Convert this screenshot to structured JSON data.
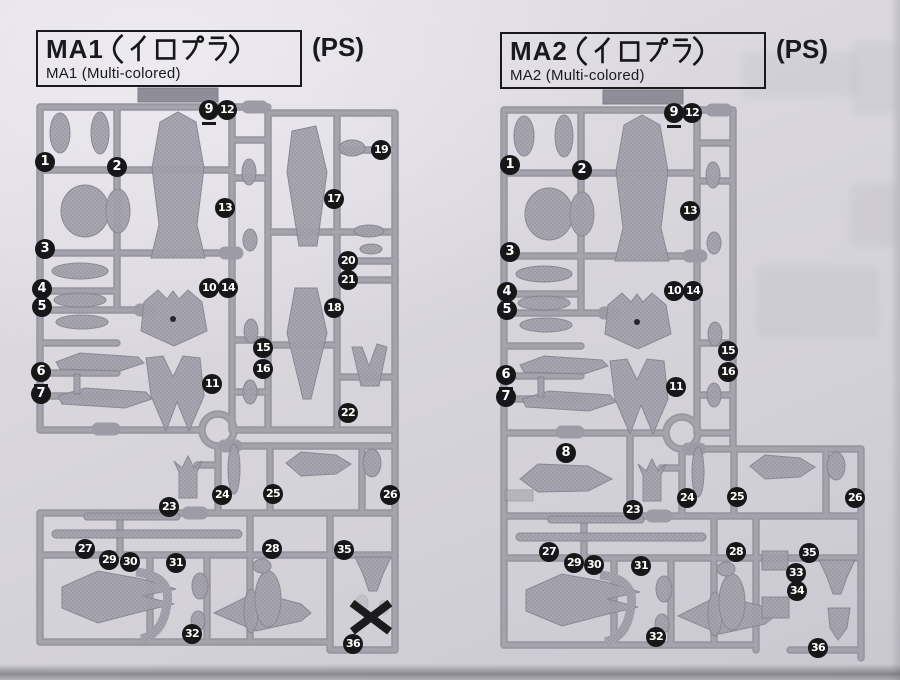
{
  "colors": {
    "paper": "#d9d7dd",
    "paper_light": "#e6e4ea",
    "runner": "#a7a5ae",
    "runner_dark": "#908e98",
    "runner_light": "#bbb9c1",
    "part": "#a3a1ab",
    "ink": "#1a1a1c",
    "badge_bg": "#17171a",
    "badge_fg": "#ffffff",
    "tab": "#97959f"
  },
  "panels": [
    {
      "id": "MA1",
      "title_prefix": "MA1",
      "title_kana_full": "（イロプラ）",
      "title_jp_full": "MA1（イロプラ）",
      "ps_label": "(PS)",
      "subtitle": "MA1 (Multi-colored)",
      "badges": [
        {
          "n": 1,
          "x": 45,
          "y": 162
        },
        {
          "n": 2,
          "x": 117,
          "y": 167
        },
        {
          "n": 3,
          "x": 45,
          "y": 249
        },
        {
          "n": 4,
          "x": 42,
          "y": 289
        },
        {
          "n": 5,
          "x": 42,
          "y": 307
        },
        {
          "n": 6,
          "x": 41,
          "y": 372,
          "u": true
        },
        {
          "n": 7,
          "x": 41,
          "y": 394
        },
        {
          "n": 9,
          "x": 209,
          "y": 110,
          "u": true
        },
        {
          "n": 10,
          "x": 209,
          "y": 288
        },
        {
          "n": 11,
          "x": 212,
          "y": 384
        },
        {
          "n": 12,
          "x": 227,
          "y": 110
        },
        {
          "n": 13,
          "x": 225,
          "y": 208
        },
        {
          "n": 14,
          "x": 228,
          "y": 288
        },
        {
          "n": 15,
          "x": 263,
          "y": 348
        },
        {
          "n": 16,
          "x": 263,
          "y": 369
        },
        {
          "n": 17,
          "x": 334,
          "y": 199
        },
        {
          "n": 18,
          "x": 334,
          "y": 308
        },
        {
          "n": 19,
          "x": 381,
          "y": 150
        },
        {
          "n": 20,
          "x": 348,
          "y": 261
        },
        {
          "n": 21,
          "x": 348,
          "y": 280
        },
        {
          "n": 22,
          "x": 348,
          "y": 413
        },
        {
          "n": 23,
          "x": 169,
          "y": 507
        },
        {
          "n": 24,
          "x": 222,
          "y": 495
        },
        {
          "n": 25,
          "x": 273,
          "y": 494
        },
        {
          "n": 26,
          "x": 390,
          "y": 495
        },
        {
          "n": 27,
          "x": 85,
          "y": 549
        },
        {
          "n": 28,
          "x": 272,
          "y": 549
        },
        {
          "n": 29,
          "x": 109,
          "y": 560
        },
        {
          "n": 30,
          "x": 130,
          "y": 562
        },
        {
          "n": 31,
          "x": 176,
          "y": 563
        },
        {
          "n": 32,
          "x": 192,
          "y": 634
        },
        {
          "n": 35,
          "x": 344,
          "y": 550
        },
        {
          "n": 36,
          "x": 353,
          "y": 644
        }
      ],
      "not_used_mark": {
        "x": 371,
        "y": 617
      }
    },
    {
      "id": "MA2",
      "title_prefix": "MA2",
      "title_kana_full": "（イロプラ）",
      "title_jp_full": "MA2（イロプラ）",
      "ps_label": "(PS)",
      "subtitle": "MA2 (Multi-colored)",
      "badges": [
        {
          "n": 1,
          "x": 510,
          "y": 165
        },
        {
          "n": 2,
          "x": 582,
          "y": 170
        },
        {
          "n": 3,
          "x": 510,
          "y": 252
        },
        {
          "n": 4,
          "x": 507,
          "y": 292
        },
        {
          "n": 5,
          "x": 507,
          "y": 310
        },
        {
          "n": 6,
          "x": 506,
          "y": 375,
          "u": true
        },
        {
          "n": 7,
          "x": 506,
          "y": 397
        },
        {
          "n": 8,
          "x": 566,
          "y": 453
        },
        {
          "n": 9,
          "x": 674,
          "y": 113,
          "u": true
        },
        {
          "n": 10,
          "x": 674,
          "y": 291
        },
        {
          "n": 11,
          "x": 676,
          "y": 387
        },
        {
          "n": 12,
          "x": 692,
          "y": 113
        },
        {
          "n": 13,
          "x": 690,
          "y": 211
        },
        {
          "n": 14,
          "x": 693,
          "y": 291
        },
        {
          "n": 15,
          "x": 728,
          "y": 351
        },
        {
          "n": 16,
          "x": 728,
          "y": 372
        },
        {
          "n": 23,
          "x": 633,
          "y": 510
        },
        {
          "n": 24,
          "x": 687,
          "y": 498
        },
        {
          "n": 25,
          "x": 737,
          "y": 497
        },
        {
          "n": 26,
          "x": 855,
          "y": 498
        },
        {
          "n": 27,
          "x": 549,
          "y": 552
        },
        {
          "n": 28,
          "x": 736,
          "y": 552
        },
        {
          "n": 29,
          "x": 574,
          "y": 563
        },
        {
          "n": 30,
          "x": 594,
          "y": 565
        },
        {
          "n": 31,
          "x": 641,
          "y": 566
        },
        {
          "n": 32,
          "x": 656,
          "y": 637
        },
        {
          "n": 33,
          "x": 796,
          "y": 573
        },
        {
          "n": 34,
          "x": 797,
          "y": 591
        },
        {
          "n": 35,
          "x": 809,
          "y": 553
        },
        {
          "n": 36,
          "x": 818,
          "y": 648
        }
      ],
      "not_used_mark": null
    }
  ]
}
